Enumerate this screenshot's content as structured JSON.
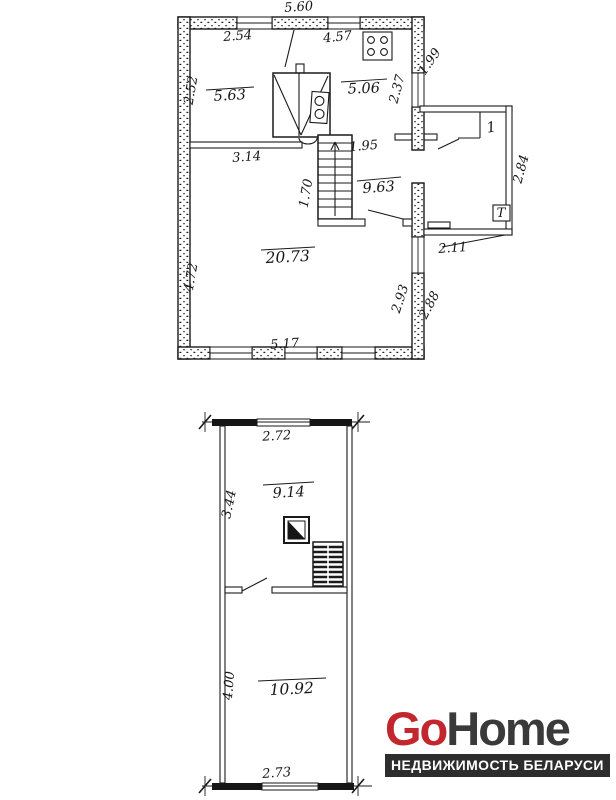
{
  "document": {
    "background": "#ffffff"
  },
  "upper_plan": {
    "overall_width": "5.60",
    "top_window_left": "2.54",
    "top_window_right": "4.57",
    "left_wall_upper": "2.52",
    "left_wall_lower": "4.72",
    "bottom_wall": "5.17",
    "right_wall_upper_inner": "2.37",
    "right_wall_upper_outer": "1.99",
    "right_wall_lower_inner": "2.93",
    "right_wall_lower_outer": "2.88",
    "partition_width": "3.14",
    "stair_opening": "1.95",
    "stair_run": "1.70",
    "room_topleft_area": "5.63",
    "room_kitchen_area": "5.06",
    "room_hall_area": "9.63",
    "room_living_area": "20.73",
    "porch_room_number": "1",
    "porch_depth": "2.84",
    "porch_width": "2.11",
    "porch_fixture_letter": "Т"
  },
  "lower_plan": {
    "top_width": "2.72",
    "bottom_width": "2.73",
    "upper_room_height": "3.44",
    "lower_room_height": "4.00",
    "upper_room_area": "9.14",
    "lower_room_area": "10.92"
  },
  "logo": {
    "word_go": "Go",
    "word_home": "Home",
    "tagline": "НЕДВИЖИМОСТЬ БЕЛАРУСИ",
    "go_color": "#c1272d",
    "home_color": "#3a3a3a",
    "tagline_bg": "#2d2d2d",
    "tagline_fg": "#ffffff"
  }
}
